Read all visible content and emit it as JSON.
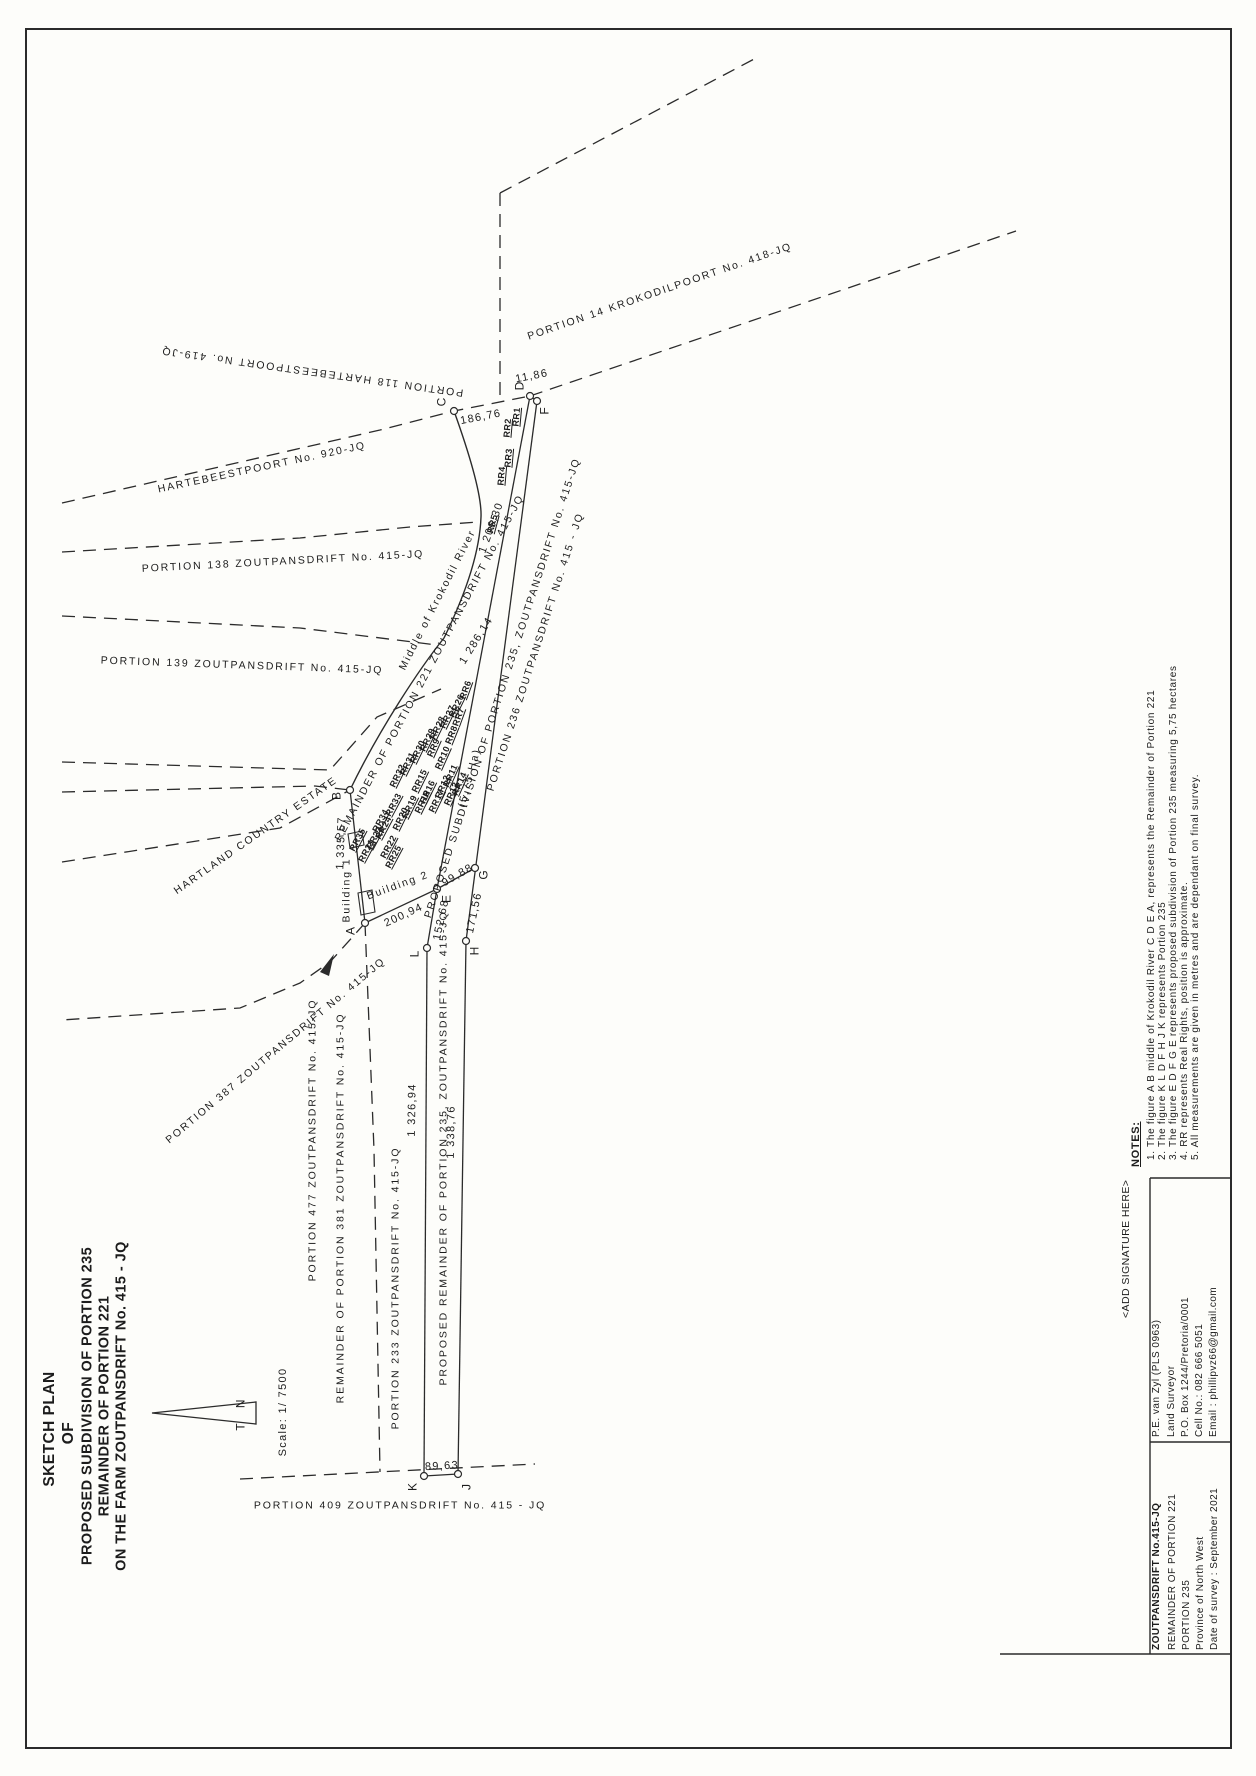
{
  "title": {
    "lines": [
      "SKETCH PLAN",
      "OF",
      "PROPOSED SUBDIVISION OF PORTION 235",
      "REMAINDER OF PORTION 221",
      "ON THE FARM ZOUTPANSDRIFT No. 415 - JQ"
    ]
  },
  "north": {
    "true_north": "T  N"
  },
  "scale": {
    "text": "Scale: 1/ 7500"
  },
  "points": [
    "A",
    "B",
    "C",
    "D",
    "E",
    "F",
    "G",
    "H",
    "J",
    "K",
    "L"
  ],
  "measurements": [
    "186,76",
    "11,86",
    "1 206,30",
    "1 286,14",
    "1 335,57",
    "200,94",
    "152,68",
    "99,88",
    "171,56",
    "1 326,94",
    "1 338,76",
    "89,63"
  ],
  "parcels": [
    "PORTION 14 KROKODILPOORT No. 418-JQ",
    "PORTION 118 HARTEBEESTPOORT No. 419-JQ",
    "HARTEBEESTPOORT No. 920-JQ",
    "PORTION 138 ZOUTPANSDRIFT No. 415-JQ",
    "PORTION 139 ZOUTPANSDRIFT No. 415-JQ",
    "HARTLAND COUNTRY ESTATE",
    "PORTION 387 ZOUTPANSDRIFT No. 415-JQ",
    "PORTION 477 ZOUTPANSDRIFT No. 415-JQ",
    "REMAINDER OF PORTION 381 ZOUTPANSDRIFT No. 415-JQ",
    "PORTION 233 ZOUTPANSDRIFT No. 415-JQ",
    "PROPOSED REMAINDER OF PORTION 235, ZOUTPANSDRIFT No. 415-JQ",
    "PORTION 409 ZOUTPANSDRIFT No. 415 - JQ",
    "REMAINDER OF PORTION 221 ZOUTPANSDRIFT No. 415-JQ",
    "Middle of Krokodil River",
    "PROPOSED SUBDIVISION OF PORTION 235, ZOUTPANSDRIFT No. 415-JQ",
    "PORTION 236 ZOUTPANSDRIFT No. 415 - JQ",
    "(5,75 Ha)",
    "Building 1",
    "Building 2"
  ],
  "rr_labels": [
    "RR1",
    "RR2",
    "RR3",
    "RR4",
    "RR5",
    "RR6",
    "RR7",
    "RR8",
    "RR9",
    "RR10",
    "RR11",
    "RR12",
    "RR13",
    "RR14",
    "RR15",
    "RR16",
    "RR17",
    "RR18",
    "RR19",
    "RR20",
    "RR21",
    "RR22",
    "RR23",
    "RR24",
    "RR25",
    "RR26",
    "RR27",
    "RR28",
    "RR29",
    "RR30",
    "RR31",
    "RR32",
    "RR33",
    "RR34",
    "RR35"
  ],
  "notes": {
    "heading": "NOTES:",
    "items": [
      "1. The figure A B middle of Krokodil River C D E A, represents the Remainder of Portion 221",
      "2. The figure K L D F H J K represents Portion 235",
      "3. The figure E D F G E represents proposed subdivision of Portion 235 measuring 5,75 hectares",
      "4. RR represents Real Rights, position is approximate.",
      "5. All measurements are given in metres and are dependant on final survey."
    ]
  },
  "signature_placeholder": "<ADD SIGNATURE HERE>",
  "title_block": {
    "project": [
      "ZOUTPANSDRIFT No.415-JQ",
      "REMAINDER OF PORTION 221",
      "PORTION 235",
      "Province of North West",
      "Date of survey : September 2021"
    ],
    "surveyor": [
      "P.E. van Zyl (PLS 0963)",
      "Land Surveyor",
      "P.O. Box 1244/Pretoria/0001",
      "Cell No.: 082 666 5051",
      "Email : phillipvz66@gmail.com"
    ]
  },
  "colors": {
    "ink": "#1c1c1c",
    "paper": "#fdfdfa"
  }
}
